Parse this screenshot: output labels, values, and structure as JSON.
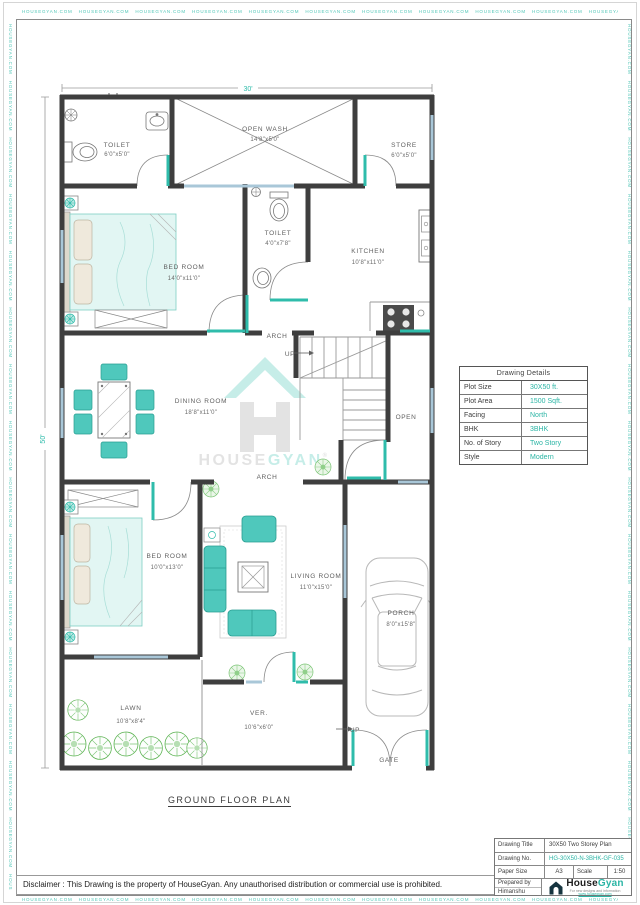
{
  "watermark": {
    "text": "HOUSEGYAN.COM"
  },
  "page": {
    "plan_title": "GROUND FLOOR PLAN"
  },
  "dimensions": {
    "top": "30'",
    "left": "50'"
  },
  "rooms": {
    "toilet1": {
      "name": "TOILET",
      "size": "6'0\"x5'0\""
    },
    "open_wash": {
      "name": "OPEN WASH",
      "size": "14'8\"x5'0\""
    },
    "store": {
      "name": "STORE",
      "size": "6'0\"x5'0\""
    },
    "bedroom1": {
      "name": "BED ROOM",
      "size": "14'0\"x11'0\""
    },
    "toilet2": {
      "name": "TOILET",
      "size": "4'0\"x7'8\""
    },
    "kitchen": {
      "name": "KITCHEN",
      "size": "10'8\"x11'0\""
    },
    "dining": {
      "name": "DINING ROOM",
      "size": "18'8\"x11'0\""
    },
    "bedroom2": {
      "name": "BED ROOM",
      "size": "10'0\"x13'0\""
    },
    "living": {
      "name": "LIVING ROOM",
      "size": "11'0\"x15'0\""
    },
    "porch": {
      "name": "PORCH",
      "size": "8'0\"x15'8\""
    },
    "lawn": {
      "name": "LAWN",
      "size": "10'8\"x8'4\""
    },
    "verandah": {
      "name": "VER.",
      "size": "10'6\"x6'0\""
    }
  },
  "annotations": {
    "arch_top": "ARCH",
    "arch_bottom": "ARCH",
    "up_stairs": "UP",
    "up_gate": "UP",
    "open": "OPEN",
    "gate": "GATE"
  },
  "center_watermark": {
    "house": "HOUSE",
    "gyan": "GYAN",
    "reg": "®"
  },
  "details_table": {
    "title": "Drawing Details",
    "rows": [
      {
        "label": "Plot Size",
        "value": "30X50 ft."
      },
      {
        "label": "Plot Area",
        "value": "1500 Sqft."
      },
      {
        "label": "Facing",
        "value": "North"
      },
      {
        "label": "BHK",
        "value": "3BHK"
      },
      {
        "label": "No. of Story",
        "value": "Two Story"
      },
      {
        "label": "Style",
        "value": "Modern"
      }
    ]
  },
  "title_block": {
    "drawing_title_label": "Drawing Title",
    "drawing_title": "30X50 Two Storey Plan",
    "drawing_no_label": "Drawing No.",
    "drawing_no": "HG-30X50-N-3BHK-GF-035",
    "paper_size_label": "Paper Size",
    "paper_size": "A3",
    "scale_label": "Scale",
    "scale": "1:50",
    "prepared_by_label": "Prepared by",
    "prepared_by": "Himanshu",
    "brand_house": "House",
    "brand_gyan": "Gyan",
    "brand_tagline": "For new designs and information",
    "brand_url": "www.housegyan.com"
  },
  "disclaimer": "Disclaimer : This Drawing is the property of HouseGyan. Any unauthorised distribution or commercial use is prohibited.",
  "colors": {
    "accent_teal": "#2fbcab",
    "wall": "#3e3e3e",
    "window_blue": "#a9c7d8",
    "furniture_teal": "#4fc8bc",
    "plant_green": "#5cb352",
    "value_teal": "#2bb5a5"
  }
}
